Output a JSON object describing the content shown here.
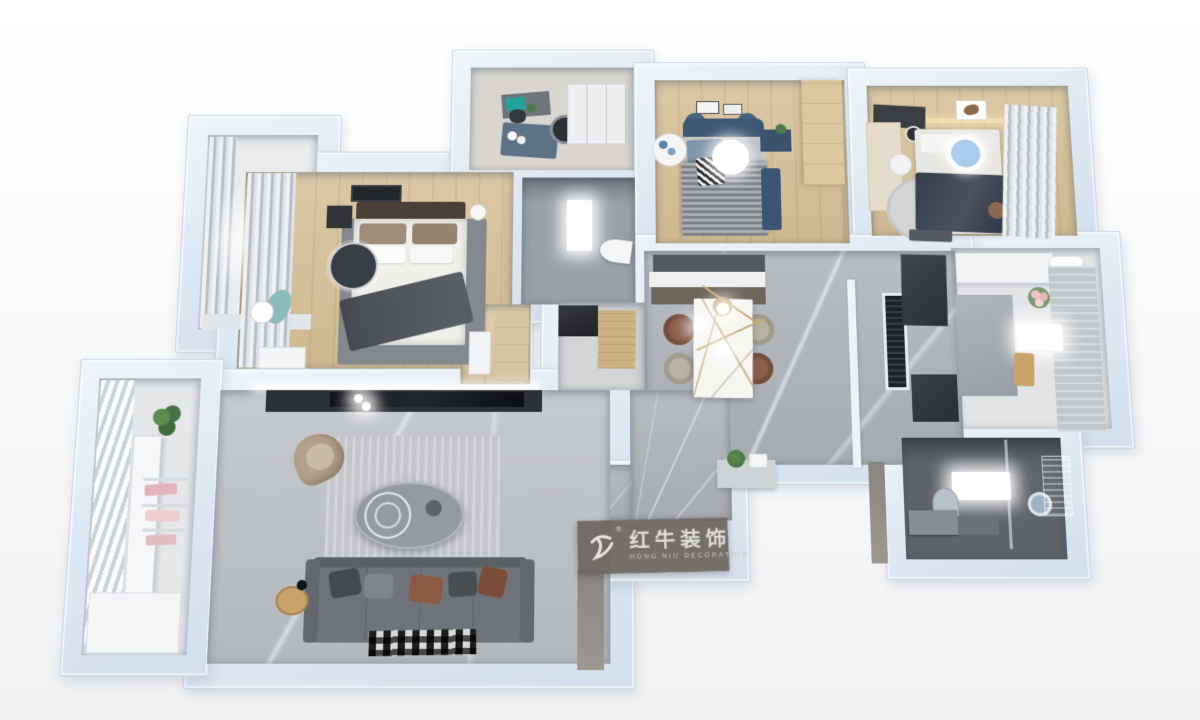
{
  "image_type": "3d-floor-plan-render",
  "view": "top-down isometric apartment rendering",
  "watermark": {
    "brand_cn": "红牛装饰",
    "brand_en": "HONG NIU DECORATION",
    "registered_mark": "®",
    "logo_icon": "bull-swoosh-icon",
    "plate_color": "#6e6761",
    "text_color": "#dcdddd"
  },
  "palette": {
    "wall": "#dde7f1",
    "wall_edge": "#c8d5e3",
    "wood_floor": "#d7c29a",
    "marble_floor": "#b6b9be",
    "dark_bath_tile": "#60646a",
    "accent_teal": "#25a09a",
    "accent_navy": "#3e5875",
    "accent_light_blue": "#a9ccef",
    "accent_rust": "#8c5943",
    "background": "#f4f5f6"
  },
  "scene": {
    "rooms": [
      {
        "id": "balcony-top-left",
        "furniture": [
          "curtains",
          "window-ledge"
        ]
      },
      {
        "id": "master-bedroom",
        "furniture": [
          "double-bed",
          "dark-throw-blanket",
          "area-rug",
          "ceiling-fan",
          "nightstand",
          "bedside-lamp",
          "foot-bench",
          "whale-cushion",
          "curtains",
          "ceiling-light-frame"
        ]
      },
      {
        "id": "study",
        "furniture": [
          "desk",
          "teal-desk-mat",
          "office-chair",
          "round-lounge-chair",
          "blue-rug",
          "white-wardrobe"
        ]
      },
      {
        "id": "bathroom-middle",
        "furniture": [
          "ceiling-light",
          "toilet"
        ]
      },
      {
        "id": "bedroom-2",
        "furniture": [
          "bed",
          "striped-blanket",
          "navy-headboard",
          "round-ceiling-light",
          "nightstand-plant",
          "round-side-table",
          "wood-wardrobe",
          "navy-rug",
          "wall-art"
        ]
      },
      {
        "id": "bedroom-3",
        "furniture": [
          "bed",
          "navy-blanket",
          "blue-round-ceiling-light",
          "desk",
          "desk-chair",
          "round-rug",
          "curtains",
          "wall-art",
          "warm-led-strip",
          "pouf"
        ]
      },
      {
        "id": "kitchen",
        "furniture": [
          "upper-cabinets",
          "range-hood",
          "side-counter",
          "tall-cabinet",
          "island-ceiling-light",
          "flower-vase",
          "cutting-board"
        ]
      },
      {
        "id": "dining-area",
        "furniture": [
          "marble-dining-table",
          "brown-chairs",
          "beige-chairs",
          "gold-pendant-lamp",
          "sideboard",
          "wall-panel"
        ]
      },
      {
        "id": "hallway",
        "furniture": [
          "ac-floor-vent",
          "dark-wall-panels",
          "console-shelf",
          "potted-plant",
          "white-pillar"
        ]
      },
      {
        "id": "entry",
        "furniture": [
          "shoe-cabinet",
          "wood-door-mat"
        ]
      },
      {
        "id": "bathroom-master",
        "furniture": [
          "ceiling-light",
          "round-mirror",
          "arch-mirror",
          "vanity",
          "glass-partition",
          "shower-screen"
        ]
      },
      {
        "id": "living-room",
        "furniture": [
          "tv",
          "tv-console",
          "led-strip",
          "tan-lounge-chair",
          "oval-coffee-table",
          "ring-decor",
          "area-rug",
          "gray-sofa",
          "throw-pillows",
          "patterned-mat",
          "wood-stool",
          "floor-lamp"
        ]
      },
      {
        "id": "balcony-left",
        "furniture": [
          "blinds",
          "drying-rack",
          "hanging-clothes",
          "potted-plant",
          "storage-cabinet"
        ]
      }
    ]
  }
}
